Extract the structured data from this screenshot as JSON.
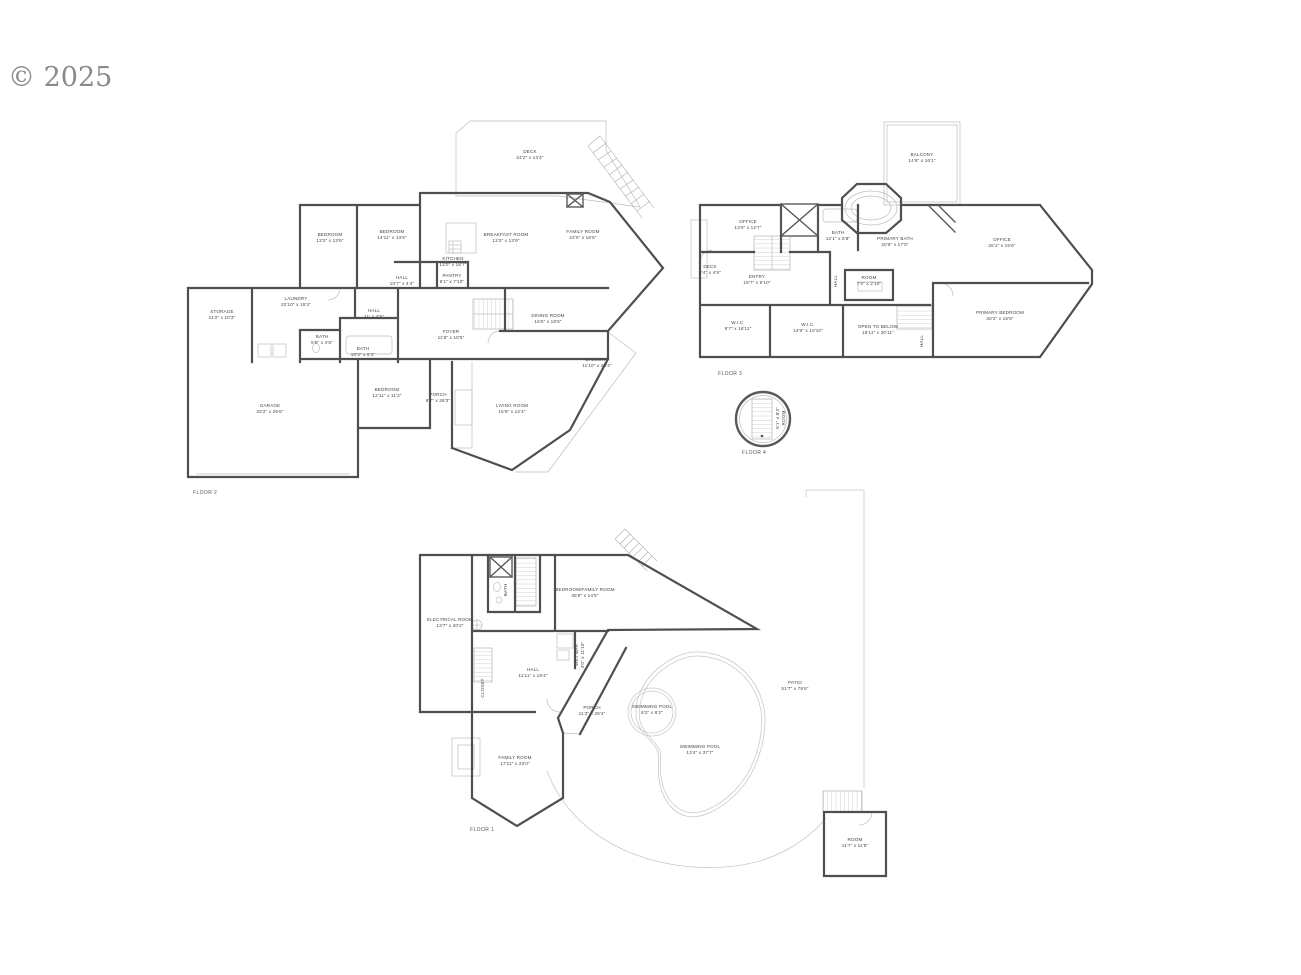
{
  "watermark": "© 2025",
  "colors": {
    "wall": "#4f4f4f",
    "thin_line": "#bdbdbd",
    "text": "#454545",
    "watermark": "#8a8a8a"
  },
  "floors": {
    "f2": {
      "label": "FLOOR 2",
      "rooms": {
        "deck": {
          "name": "DECK",
          "dims": "24'2\" x 13'4\""
        },
        "bedroom1": {
          "name": "BEDROOM",
          "dims": "13'2\" x 13'6\""
        },
        "bedroom2": {
          "name": "BEDROOM",
          "dims": "14'11\" x 13'6\""
        },
        "breakfast": {
          "name": "BREAKFAST ROOM",
          "dims": "13'2\" x 13'9\""
        },
        "family": {
          "name": "FAMILY ROOM",
          "dims": "22'0\" x 16'5\""
        },
        "kitchen": {
          "name": "KITCHEN",
          "dims": "13'0\" x 18'7\""
        },
        "hall_upper": {
          "name": "HALL",
          "dims": "10'7\" x 4'4\""
        },
        "pantry": {
          "name": "PANTRY",
          "dims": "6'1\" x 7'10\""
        },
        "laundry": {
          "name": "LAUNDRY",
          "dims": "22'10\" x 15'3\""
        },
        "storage": {
          "name": "STORAGE",
          "dims": "11'2\" x 10'3\""
        },
        "hall_mid": {
          "name": "HALL",
          "dims": "11' x 4'9\""
        },
        "bath1": {
          "name": "BATH",
          "dims": "5'9\" x 4'8\""
        },
        "bath2": {
          "name": "BATH",
          "dims": "10'3\" x 6'1\""
        },
        "dining": {
          "name": "DINING ROOM",
          "dims": "16'5\" x 18'6\""
        },
        "foyer": {
          "name": "FOYER",
          "dims": "11'6\" x 10'5\""
        },
        "balcony": {
          "name": "BALCONY",
          "dims": "11'10\" x 28'4\""
        },
        "bedroom3": {
          "name": "BEDROOM",
          "dims": "12'11\" x 11'2\""
        },
        "porch": {
          "name": "PORCH",
          "dims": "8'7\" x 28'3\""
        },
        "living": {
          "name": "LIVING ROOM",
          "dims": "15'9\" x 12'4\""
        },
        "garage": {
          "name": "GARAGE",
          "dims": "33'2\" x 26'6\""
        }
      }
    },
    "f3": {
      "label": "FLOOR 3",
      "rooms": {
        "balcony": {
          "name": "BALCONY",
          "dims": "14'8\" x 16'1\""
        },
        "office1": {
          "name": "OFFICE",
          "dims": "13'0\" x 12'7\""
        },
        "bath": {
          "name": "BATH",
          "dims": "12'1\" x 6'8\""
        },
        "primary_bath": {
          "name": "PRIMARY BATH",
          "dims": "20'5\" x 17'0\""
        },
        "office2": {
          "name": "OFFICE",
          "dims": "26'1\" x 15'6\""
        },
        "deck": {
          "name": "DECK",
          "dims": "2'4\" x 4'9\""
        },
        "entry": {
          "name": "ENTRY",
          "dims": "18'7\" x 9'10\""
        },
        "room": {
          "name": "ROOM",
          "dims": "7'0\" x 2'10\""
        },
        "hall1": {
          "name": "HALL"
        },
        "wic1": {
          "name": "W.I.C.",
          "dims": "9'7\" x 16'11\""
        },
        "wic2": {
          "name": "W.I.C.",
          "dims": "14'8\" x 10'10\""
        },
        "open_below": {
          "name": "OPEN TO BELOW",
          "dims": "19'11\" x 30'11\""
        },
        "primary_bedroom": {
          "name": "PRIMARY BEDROOM",
          "dims": "30'2\" x 15'8\""
        },
        "hall2": {
          "name": "HALL"
        }
      }
    },
    "f4": {
      "label": "FLOOR 4",
      "rooms": {
        "room": {
          "name": "ROOM",
          "dims": "5'1\" x 8'3\""
        }
      }
    },
    "f1": {
      "label": "FLOOR 1",
      "rooms": {
        "electrical": {
          "name": "ELECTRICAL ROOM",
          "dims": "13'7\" x 20'2\""
        },
        "bed_family": {
          "name": "BEDROOM/FAMILY ROOM",
          "dims": "35'8\" x 14'5\""
        },
        "hall": {
          "name": "HALL",
          "dims": "11'11\" x 18'4\""
        },
        "bath": {
          "name": "BATH"
        },
        "wetbar": {
          "name": "WET BAR",
          "dims": "4'0\" x 11'10\""
        },
        "closet": {
          "name": "CLOSET"
        },
        "porch": {
          "name": "PORCH",
          "dims": "11'2\" x 29'4\""
        },
        "family": {
          "name": "FAMILY ROOM",
          "dims": "17'11\" x 23'0\""
        },
        "pool_small": {
          "name": "SWIMMING POOL",
          "dims": "8'2\" x 8'2\""
        },
        "pool_big": {
          "name": "SWIMMING POOL",
          "dims": "13'4\" x 37'7\""
        },
        "patio": {
          "name": "PATIO",
          "dims": "51'7\" x 79'6\""
        },
        "room": {
          "name": "ROOM",
          "dims": "11'7\" x 11'5\""
        }
      }
    }
  }
}
